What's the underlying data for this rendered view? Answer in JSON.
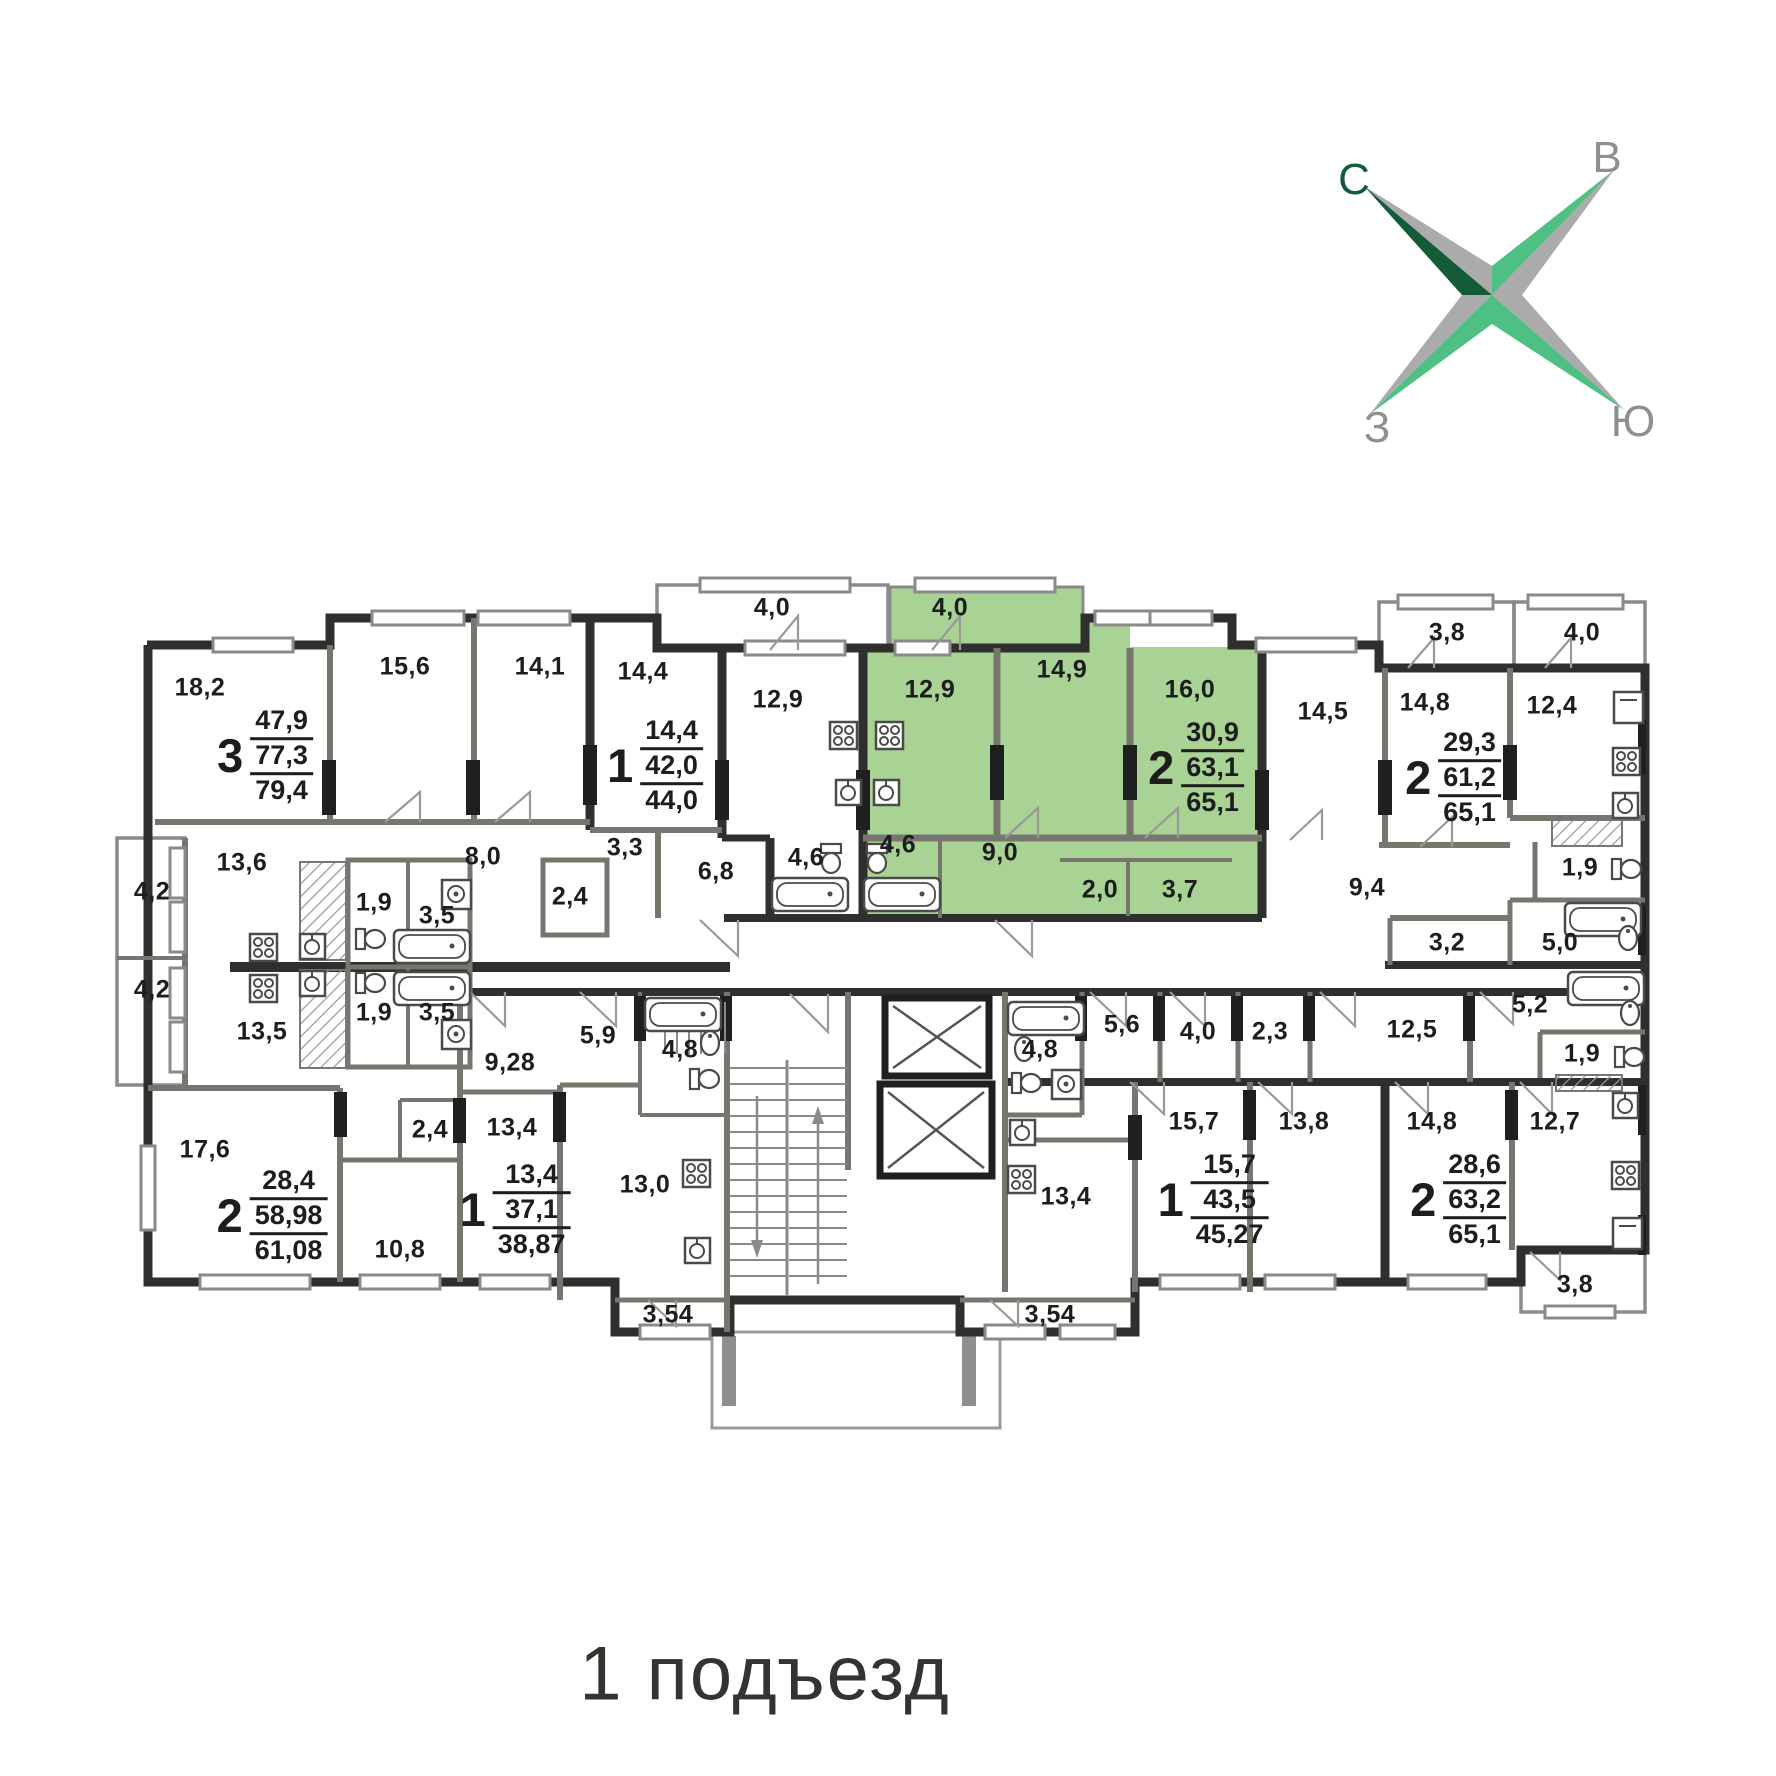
{
  "caption": "1 подъезд",
  "compass": {
    "north": "С",
    "east": "В",
    "west": "З",
    "south": "Ю"
  },
  "colors": {
    "highlight_green": "#a9d295",
    "compass_dark_green": "#135c37",
    "compass_light_green": "#4fc083",
    "compass_gray": "#ababab",
    "wall_dark": "#2f2f2e",
    "wall_mid": "#76766f",
    "label_text": "#1d1d1d"
  },
  "apartments": [
    {
      "rooms": "3",
      "living_area": "47,9",
      "apartment_area": "77,3",
      "total_area": "79,4",
      "highlighted": false
    },
    {
      "rooms": "1",
      "living_area": "14,4",
      "apartment_area": "42,0",
      "total_area": "44,0",
      "highlighted": false
    },
    {
      "rooms": "2",
      "living_area": "30,9",
      "apartment_area": "63,1",
      "total_area": "65,1",
      "highlighted": true
    },
    {
      "rooms": "2",
      "living_area": "29,3",
      "apartment_area": "61,2",
      "total_area": "65,1",
      "highlighted": false
    },
    {
      "rooms": "2",
      "living_area": "28,4",
      "apartment_area": "58,98",
      "total_area": "61,08",
      "highlighted": false
    },
    {
      "rooms": "1",
      "living_area": "13,4",
      "apartment_area": "37,1",
      "total_area": "38,87",
      "highlighted": false
    },
    {
      "rooms": "1",
      "living_area": "15,7",
      "apartment_area": "43,5",
      "total_area": "45,27",
      "highlighted": false
    },
    {
      "rooms": "2",
      "living_area": "28,6",
      "apartment_area": "63,2",
      "total_area": "65,1",
      "highlighted": false
    }
  ],
  "room_areas": [
    "18,2",
    "15,6",
    "14,1",
    "14,4",
    "4,0",
    "12,9",
    "4,0",
    "12,9",
    "14,9",
    "16,0",
    "14,5",
    "3,8",
    "4,0",
    "14,8",
    "12,4",
    "4,2",
    "13,6",
    "1,9",
    "3,5",
    "8,0",
    "2,4",
    "3,3",
    "6,8",
    "4,6",
    "4,6",
    "9,0",
    "2,0",
    "3,7",
    "9,4",
    "1,9",
    "3,2",
    "5,0",
    "5,2",
    "1,9",
    "4,2",
    "13,5",
    "1,9",
    "3,5",
    "9,28",
    "5,9",
    "4,8",
    "17,6",
    "2,4",
    "13,4",
    "10,8",
    "13,0",
    "3,54",
    "4,8",
    "5,6",
    "4,0",
    "2,3",
    "12,5",
    "13,4",
    "15,7",
    "13,8",
    "14,8",
    "12,7",
    "3,54",
    "3,8"
  ]
}
